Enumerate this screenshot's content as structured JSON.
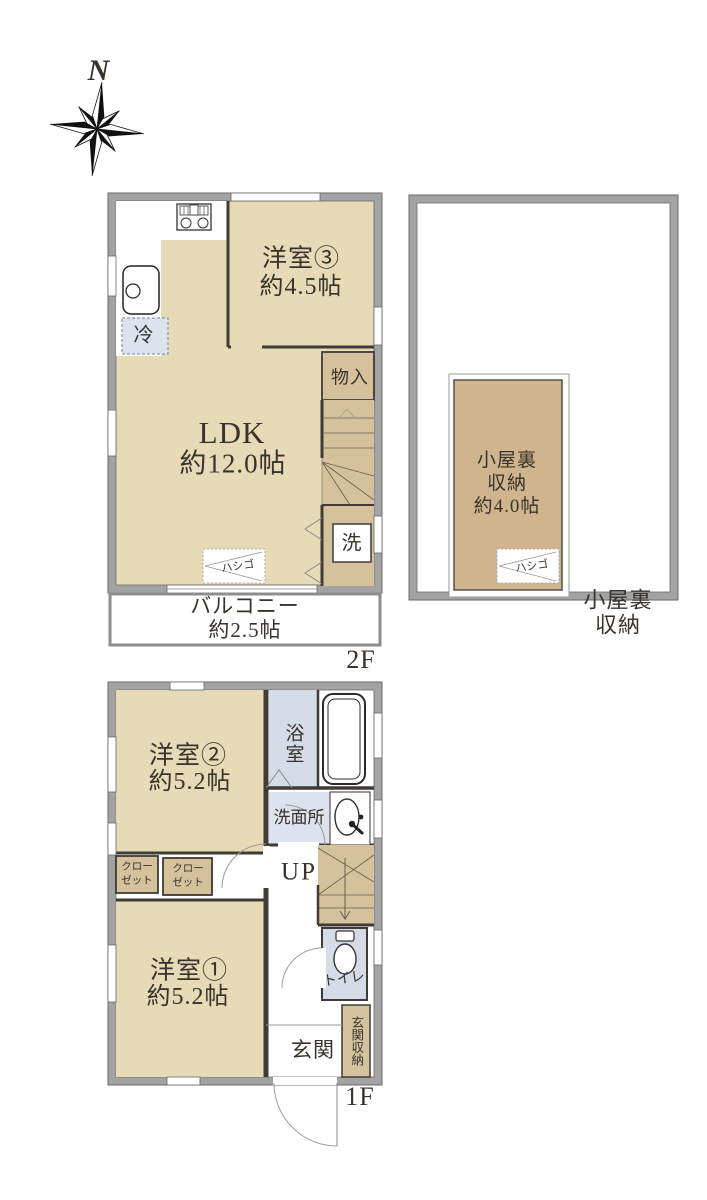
{
  "compass": {
    "north_label": "N"
  },
  "floor2": {
    "floor_label": "2F",
    "ldk_name": "LDK",
    "ldk_size": "約12.0帖",
    "room3_name": "洋室③",
    "room3_size": "約4.5帖",
    "storage_label": "物入",
    "laundry_label": "洗",
    "fridge_label": "冷",
    "ladder_label": "ハシゴ",
    "balcony_name": "バルコニー",
    "balcony_size": "約2.5帖"
  },
  "attic": {
    "caption": "小屋裏収納",
    "storage_name_line1": "小屋裏",
    "storage_name_line2": "収納",
    "storage_size": "約4.0帖",
    "ladder_label": "ハシゴ"
  },
  "floor1": {
    "floor_label": "1F",
    "room2_name": "洋室②",
    "room2_size": "約5.2帖",
    "room1_name": "洋室①",
    "room1_size": "約5.2帖",
    "bath_label": "浴室",
    "washroom_label": "洗面所",
    "toilet_label": "トイレ",
    "stairs_label": "UP",
    "closet1_label": "クロー\nゼット",
    "closet2_label": "クロー\nゼット",
    "entrance_label": "玄関",
    "entrance_storage_label": "玄関収納"
  },
  "colors": {
    "room_tan": "#e7dab6",
    "service_tan": "#d5c19b",
    "attic_tan": "#cfb48e",
    "wet_blue": "#d5dbe7",
    "washroom_blue": "#dee2ee",
    "fridge_blue": "#dce3ef",
    "wall_gray": "#a3a3a3",
    "line_dark": "#3f3b35"
  }
}
